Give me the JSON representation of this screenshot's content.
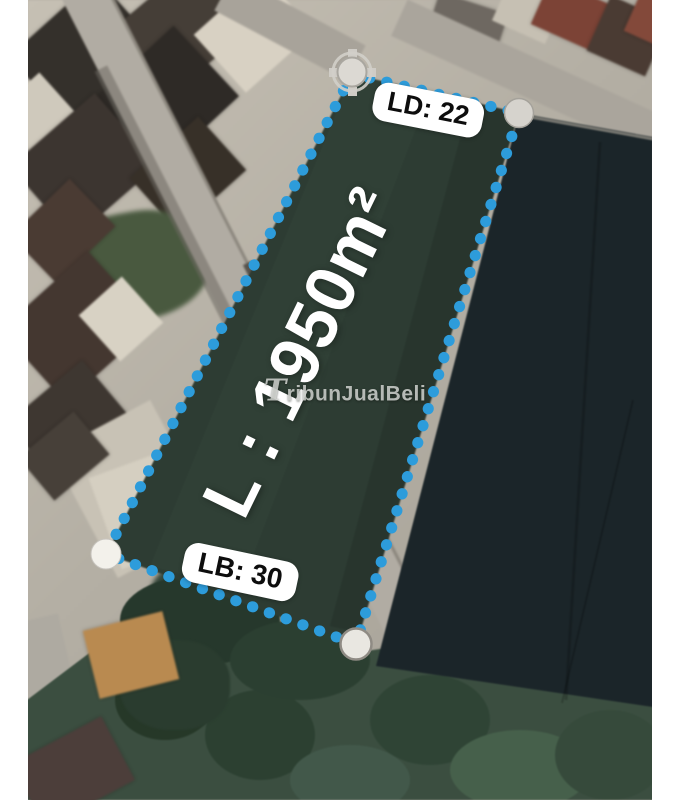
{
  "plot": {
    "area_label": "L : 1950m²",
    "front_width_label": "LD: 22",
    "back_width_label": "LB: 30"
  },
  "watermark": {
    "text": "TribunJualBeli"
  },
  "colors": {
    "boundary_dots": "#2D9CDB",
    "corner_marker": "#E6E3DD",
    "label_background": "#FFFFFF",
    "label_text": "#0D0D0D",
    "area_text": "#FFFFFF",
    "plot_field_green": "#2D3C33",
    "adjacent_field_dark": "#1B2529",
    "road_gray": "#B1ACA3",
    "photo_margin": "#FFFFFF"
  }
}
